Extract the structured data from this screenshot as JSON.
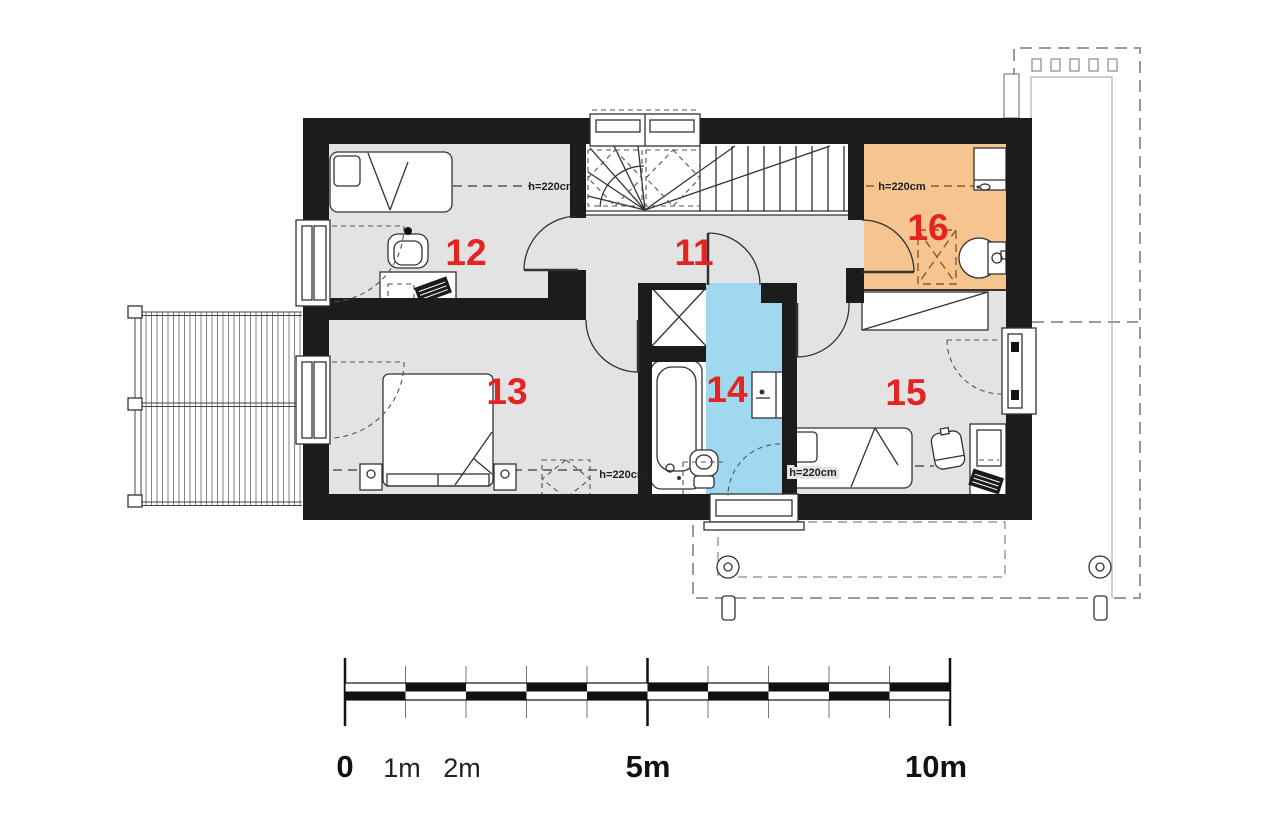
{
  "plan": {
    "rooms": {
      "r11": "11",
      "r12": "12",
      "r13": "13",
      "r14": "14",
      "r15": "15",
      "r16": "16"
    },
    "height_label": "h=220cm",
    "colors": {
      "wall": "#1c1c1c",
      "floor": "#e3e3e3",
      "bathroom_blue": "#a0d8f0",
      "bathroom_orange": "#f5c48f",
      "room_number_red": "#e52421"
    }
  },
  "scale_bar": {
    "labels": [
      "0",
      "1m",
      "2m",
      "5m",
      "10m"
    ]
  }
}
